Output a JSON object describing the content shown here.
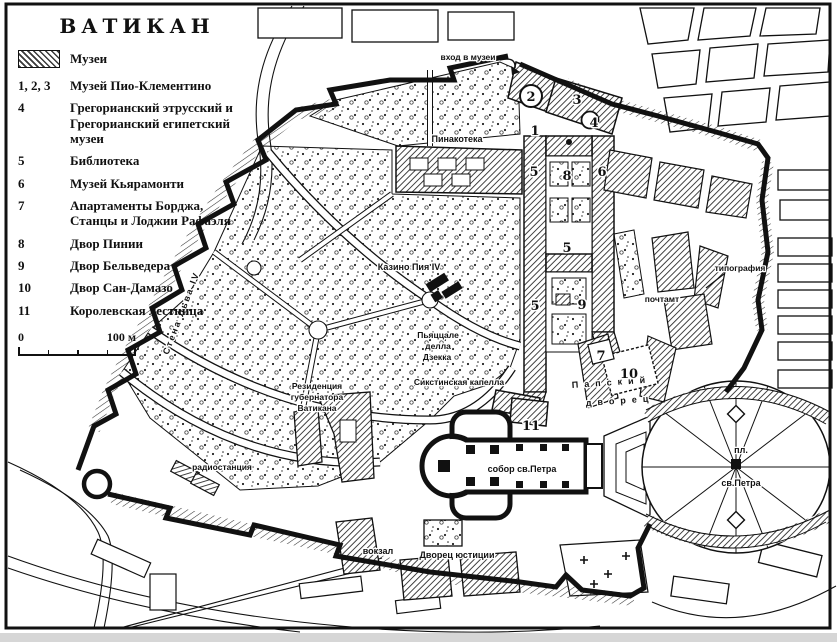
{
  "legend": {
    "title": "ВАТИКАН",
    "swatch_label": "Музеи",
    "items": [
      {
        "key": "1, 2, 3",
        "label": "Музей Пио-Клементино"
      },
      {
        "key": "4",
        "label": "Грегорианский этрусский и Грегорианский египетский музеи"
      },
      {
        "key": "5",
        "label": "Библиотека"
      },
      {
        "key": "6",
        "label": "Музей Кьярамонти"
      },
      {
        "key": "7",
        "label": "Апартаменты Борджа, Станцы и Лоджии Рафаэля"
      },
      {
        "key": "8",
        "label": "Двор Пинии"
      },
      {
        "key": "9",
        "label": "Двор Бельведера"
      },
      {
        "key": "10",
        "label": "Двор Сан-Дамазо"
      },
      {
        "key": "11",
        "label": "Королевская лестница"
      }
    ],
    "scale": {
      "zero": "0",
      "hundred": "100 м"
    }
  },
  "map": {
    "labels": {
      "entrance": "вход в музеи",
      "pinacoteca": "Пинакотека",
      "casino": "Казино Пия IV",
      "piazzale_line1": "Пьяццале",
      "piazzale_line2": "делла",
      "piazzale_line3": "Дзекка",
      "sistine": "Сикстинская капелла",
      "residence_line1": "Резиденция",
      "residence_line2": "губернатора",
      "residence_line3": "Ватикана",
      "radio": "радиостанция",
      "leo_wall": "Стена Льва IV",
      "cathedral": "собор св.Петра",
      "square_line1": "пл.",
      "square_line2": "св.Петра",
      "papal_line1": "Папский",
      "papal_line2": "дворец",
      "typografia": "типография",
      "post": "почтамт",
      "station": "вокзал",
      "justice": "Дворец юстиции"
    },
    "markers": [
      "1",
      "2",
      "3",
      "4",
      "5",
      "8",
      "6",
      "5",
      "5",
      "9",
      "7",
      "10",
      "11"
    ]
  }
}
